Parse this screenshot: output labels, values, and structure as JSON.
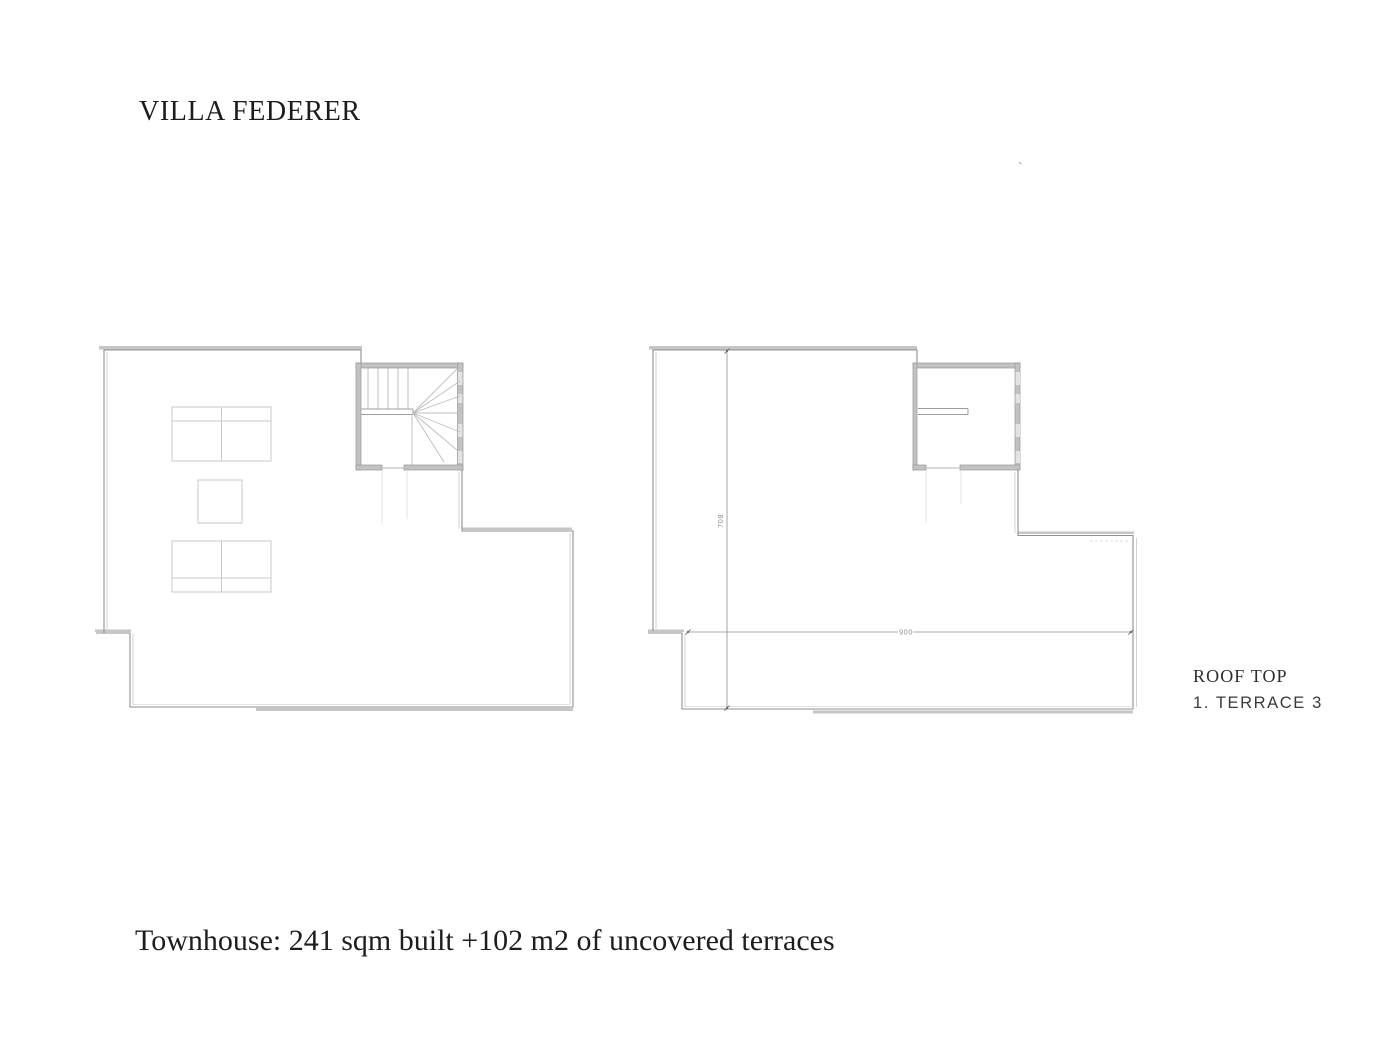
{
  "page": {
    "title": "VILLA FEDERER",
    "caption": "Townhouse: 241 sqm built +102 m2 of uncovered terraces",
    "stray_mark": "`"
  },
  "legend": {
    "title": "ROOF TOP",
    "item": "1. TERRACE 3"
  },
  "plans": {
    "right": {
      "dim_height": "708",
      "dim_width": "900"
    }
  },
  "colors": {
    "line_dark": "#8f8f8f",
    "line_light": "#cccccc",
    "wall_fill": "#c2c2c2",
    "window_fill": "#e3e3e3",
    "furniture_line": "#c9c9c9",
    "dim_line": "#8f8f8f",
    "text": "#1c1c1c"
  }
}
